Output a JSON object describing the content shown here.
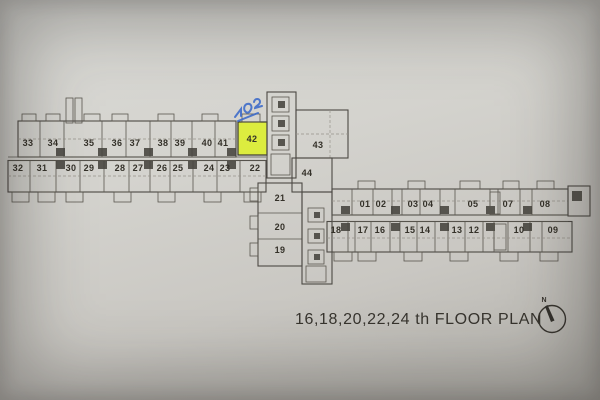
{
  "title": "16,18,20,22,24 th FLOOR PLAN",
  "compass": {
    "label": "N"
  },
  "annotations": {
    "handwritten_mark": "702-",
    "pen_color": "#3e6bc9",
    "highlighted_unit": "42",
    "highlight_color": "#dcec3f"
  },
  "units": {
    "left_top": [
      "33",
      "34",
      "35",
      "36",
      "37",
      "38",
      "39",
      "40",
      "41"
    ],
    "left_bottom": [
      "32",
      "31",
      "30",
      "29",
      "28",
      "27",
      "26",
      "25",
      "24",
      "23",
      "22"
    ],
    "center": [
      "42",
      "43",
      "44",
      "21",
      "20",
      "19"
    ],
    "right_top": [
      "01",
      "02",
      "03",
      "04",
      "05",
      "07",
      "08"
    ],
    "right_bottom": [
      "18",
      "17",
      "16",
      "15",
      "14",
      "13",
      "12",
      "10",
      "09"
    ]
  },
  "colors": {
    "paper": "#d2d1cc",
    "ink": "#4c4944",
    "digit": "#343129"
  }
}
